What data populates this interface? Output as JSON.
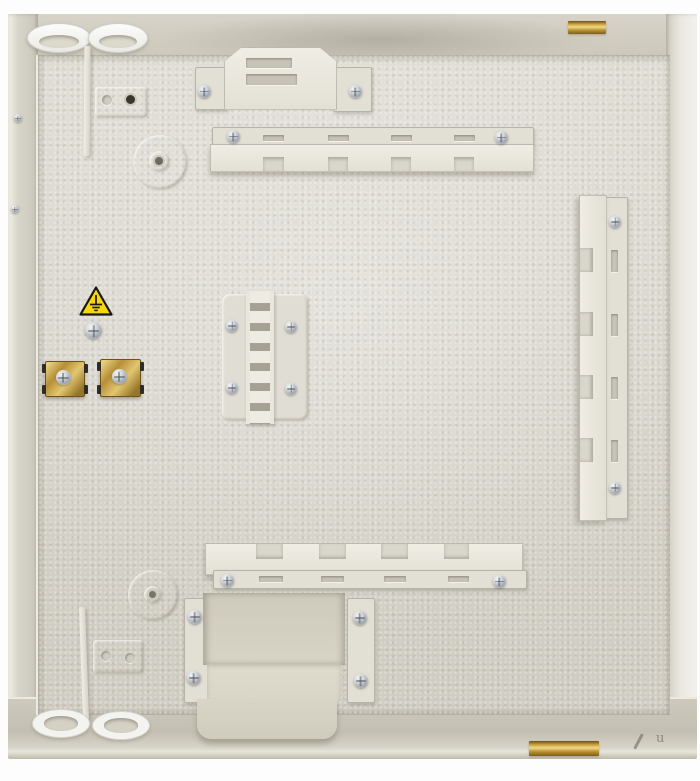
{
  "scene": {
    "type": "photograph",
    "subject": "Empty interior of a beige textured wall-mount distribution cabinet (fiber/electrical enclosure) shown open, with mounting rails, brackets, cable grommets, ground point and brass hinges",
    "view": "front view against a white backdrop"
  },
  "watermark": {
    "letter": "u"
  },
  "palette": {
    "backdrop": "#fdfdfd",
    "panel": "#dcd9d0",
    "walls_dark": "#c9c5b8",
    "bracket_light": "#efece4",
    "slot_shadow": "#c7c3b6",
    "brass": "#c9a33e",
    "screw_silver": "#c6cbd1",
    "warning_yellow": "#f6d70a",
    "warning_black": "#1a180f",
    "grommet_white": "#f3f3f0"
  },
  "parts": {
    "top_grommets": {
      "label": "round cable grommets on top wall",
      "count": 2
    },
    "bottom_grommets": {
      "label": "round cable grommets on bottom wall",
      "count": 2
    },
    "knockouts": {
      "label": "embossed circular knockouts with pilot hole",
      "count": 2
    },
    "small_plates": {
      "label": "embossed mounting plates with two holes",
      "count": 2
    },
    "top_bracket": {
      "label": "cable clamp bracket with slots",
      "slots": 2,
      "screws": 2
    },
    "top_rail": {
      "label": "horizontal notched cable-routing rail",
      "gaps": 4,
      "screws": 2
    },
    "right_rail": {
      "label": "vertical notched cable-routing rail",
      "gaps": 4,
      "screws": 2
    },
    "bottom_rail": {
      "label": "horizontal notched cable-routing rail",
      "gaps": 4,
      "screws": 2
    },
    "ladder_bracket": {
      "label": "central cable comb / ladder bracket",
      "rungs": 6,
      "screws": 4
    },
    "u_bracket": {
      "label": "U-shaped splice-tray cradle",
      "screws": 4
    },
    "cable_clamps": {
      "label": "brass zinc-chromate cable clamps with screws",
      "count": 2
    },
    "ground_point": {
      "label": "earth ground stud below yellow earth warning triangle"
    },
    "hinges": {
      "label": "brass hinge pins on right edge",
      "count": 2
    },
    "dividers": {
      "label": "thin vertical divider strips near left grommets",
      "count": 2
    }
  }
}
